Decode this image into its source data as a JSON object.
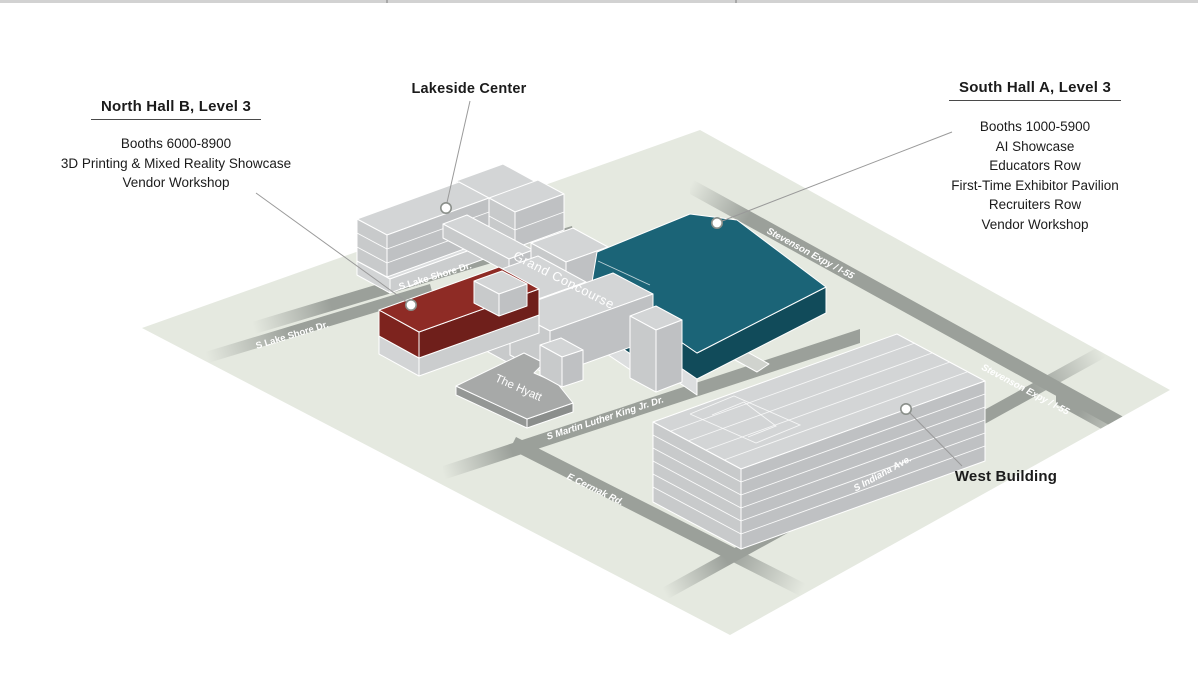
{
  "window": {
    "top_bar_color": "#d2d2d2"
  },
  "map": {
    "colors": {
      "ground": "#e5e9e0",
      "road": "#9ba09a",
      "concourse": "#d0d3ce",
      "building_top": "#d3d5d6",
      "building_sw": "#c8cacb",
      "building_se": "#bfc1c3",
      "base_top": "#dcdedf",
      "base_sw": "#d2d4d5",
      "base_se": "#cbcdce",
      "highlight_red_top": "#8e2b25",
      "highlight_red_sw": "#7d231e",
      "highlight_red_se": "#6f1f1b",
      "highlight_teal_top": "#1b6477",
      "highlight_teal_side": "#114b5a",
      "hyatt_top": "#a7a9a8",
      "hyatt_sw": "#949795",
      "hyatt_se": "#8b8e8c"
    }
  },
  "callouts": {
    "north_hall": {
      "title": "North Hall B, Level 3",
      "lines": [
        "Booths 6000-8900",
        "3D Printing & Mixed Reality Showcase",
        "Vendor Workshop"
      ]
    },
    "lakeside": {
      "title": "Lakeside Center"
    },
    "south_hall": {
      "title": "South Hall A, Level 3",
      "lines": [
        "Booths 1000-5900",
        "AI Showcase",
        "Educators Row",
        "First-Time Exhibitor Pavilion",
        "Recruiters Row",
        "Vendor Workshop"
      ]
    },
    "west_building": {
      "title": "West Building"
    }
  },
  "streets": {
    "lake_shore": "S Lake Shore Dr.",
    "grand_concourse": "Grand Concourse",
    "stevenson": "Stevenson Expy / I-55",
    "mlk": "S Martin Luther King Jr. Dr.",
    "cermak": "E Cermak Rd.",
    "indiana": "S Indiana Ave."
  },
  "venues": {
    "hyatt": "The Hyatt"
  }
}
